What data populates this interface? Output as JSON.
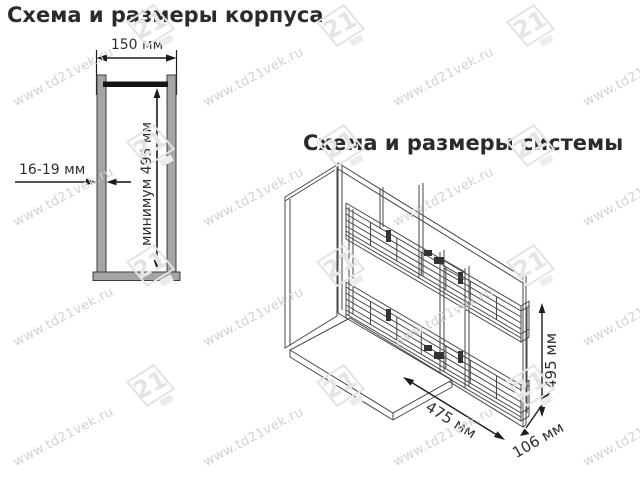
{
  "page": {
    "background": "#ffffff"
  },
  "watermark": {
    "text": "www.td21vek.ru",
    "logo_number": "21"
  },
  "cabinet_diagram": {
    "title": "Схема и размеры корпуса",
    "labels": {
      "width": "150 мм",
      "wall_thickness": "16-19 мм",
      "min_height": "минимум 495 мм"
    }
  },
  "system_diagram": {
    "title": "Схема и размеры системы",
    "labels": {
      "height": "495 мм",
      "depth": "475 мм",
      "width": "106 мм"
    }
  },
  "colors": {
    "drawing_line": "#404040",
    "dimension_line": "#1c1c1c",
    "wall_fill": "#a5a5a5",
    "rail_black": "#141414",
    "text": "#2e2e2e",
    "watermark_text": "#d2d2d2",
    "watermark_logo": "#e3e3e3"
  }
}
